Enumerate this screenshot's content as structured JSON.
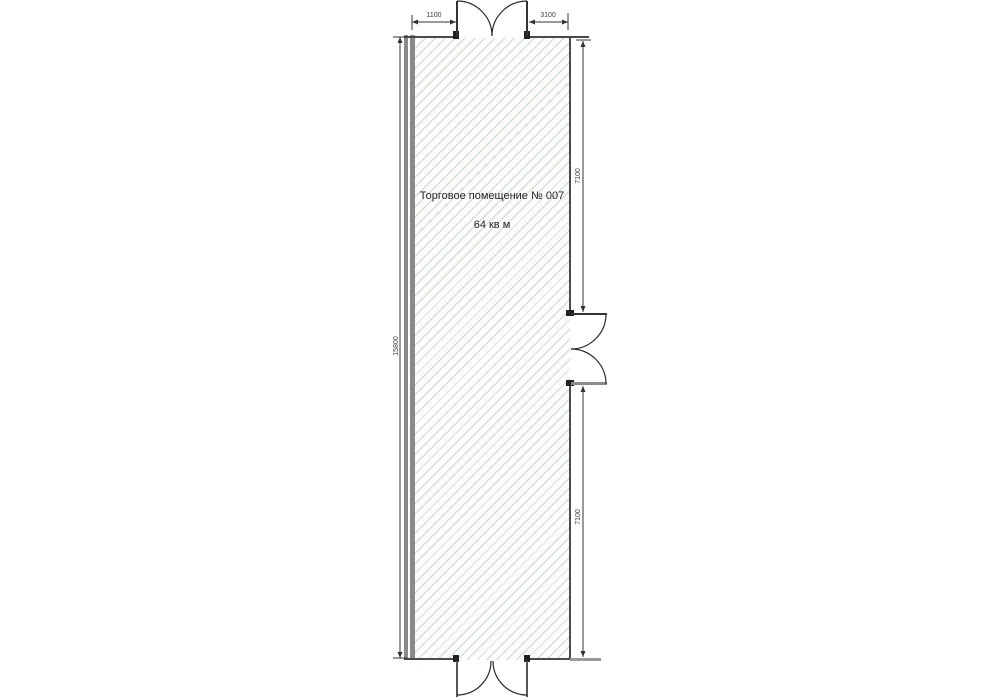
{
  "colors": {
    "hatch": "#c9d9c9",
    "wall": "#8a8a8a",
    "line": "#3a3a3a",
    "text": "#1f1f1f"
  },
  "room": {
    "title": "Торговое помещение № 007",
    "area": "64 кв м"
  },
  "dimensions": {
    "top_left": "1100",
    "top_right": "3100",
    "left_total": "15800",
    "right_upper": "7100",
    "right_lower": "7100"
  }
}
